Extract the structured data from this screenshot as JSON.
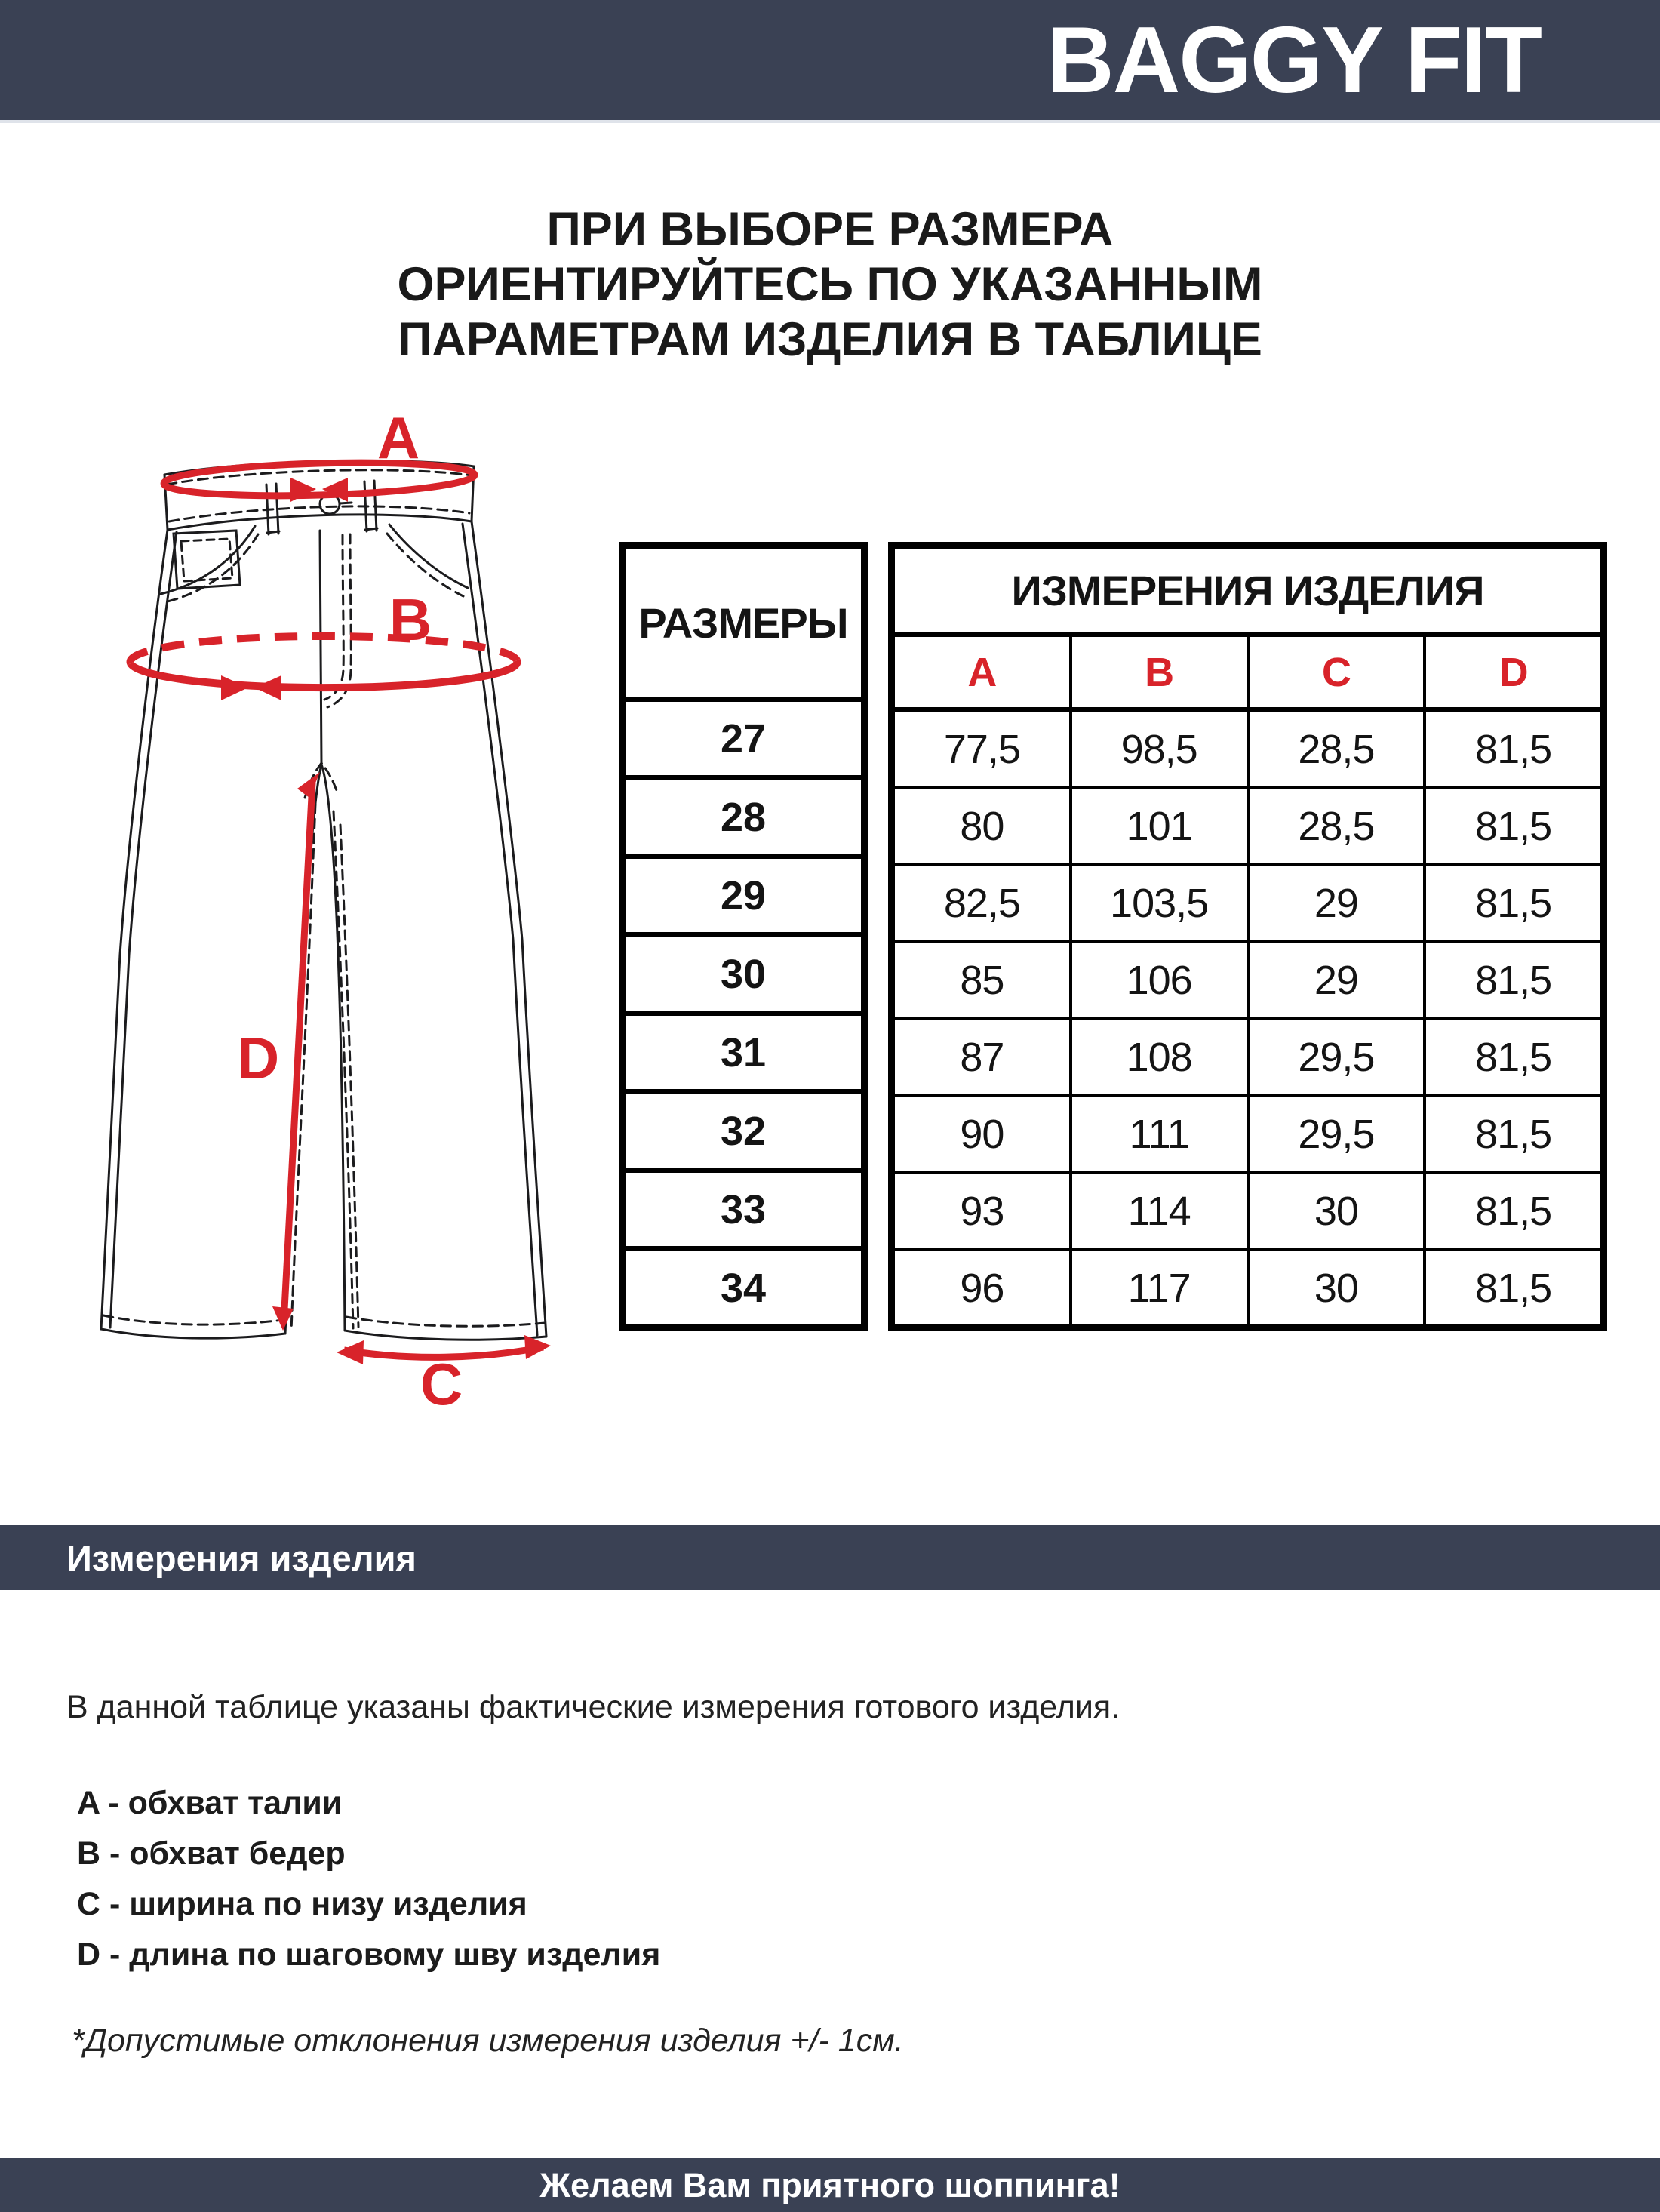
{
  "top_bar": {
    "title": "BAGGY FIT"
  },
  "intro_heading": {
    "line1": "ПРИ ВЫБОРЕ РАЗМЕРА",
    "line2": "ОРИЕНТИРУЙТЕСЬ ПО УКАЗАННЫМ",
    "line3": "ПАРАМЕТРАМ ИЗДЕЛИЯ В ТАБЛИЦЕ"
  },
  "diagram": {
    "labels": [
      "A",
      "B",
      "C",
      "D"
    ]
  },
  "size_table": {
    "size_column_header": "РАЗМЕРЫ",
    "measurements_header": "ИЗМЕРЕНИЯ ИЗДЕЛИЯ",
    "measure_labels": [
      "A",
      "B",
      "C",
      "D"
    ],
    "rows": [
      {
        "size": "27",
        "a": "77,5",
        "b": "98,5",
        "c": "28,5",
        "d": "81,5"
      },
      {
        "size": "28",
        "a": "80",
        "b": "101",
        "c": "28,5",
        "d": "81,5"
      },
      {
        "size": "29",
        "a": "82,5",
        "b": "103,5",
        "c": "29",
        "d": "81,5"
      },
      {
        "size": "30",
        "a": "85",
        "b": "106",
        "c": "29",
        "d": "81,5"
      },
      {
        "size": "31",
        "a": "87",
        "b": "108",
        "c": "29,5",
        "d": "81,5"
      },
      {
        "size": "32",
        "a": "90",
        "b": "111",
        "c": "29,5",
        "d": "81,5"
      },
      {
        "size": "33",
        "a": "93",
        "b": "114",
        "c": "30",
        "d": "81,5"
      },
      {
        "size": "34",
        "a": "96",
        "b": "117",
        "c": "30",
        "d": "81,5"
      }
    ]
  },
  "section_bar": {
    "title": "Измерения изделия"
  },
  "description": {
    "intro": "В данной таблице указаны фактические измерения готового изделия.",
    "legend": [
      "A - обхват талии",
      "B - обхват бедер",
      "C - ширина по низу изделия",
      "D - длина по шаговому шву изделия"
    ],
    "note": "*Допустимые отклонения измерения изделия +/- 1см."
  },
  "bottom_bar": {
    "message": "Желаем Вам приятного шоппинга!"
  },
  "colors": {
    "navy": "#3a4154",
    "accent_red": "#d8232a"
  }
}
